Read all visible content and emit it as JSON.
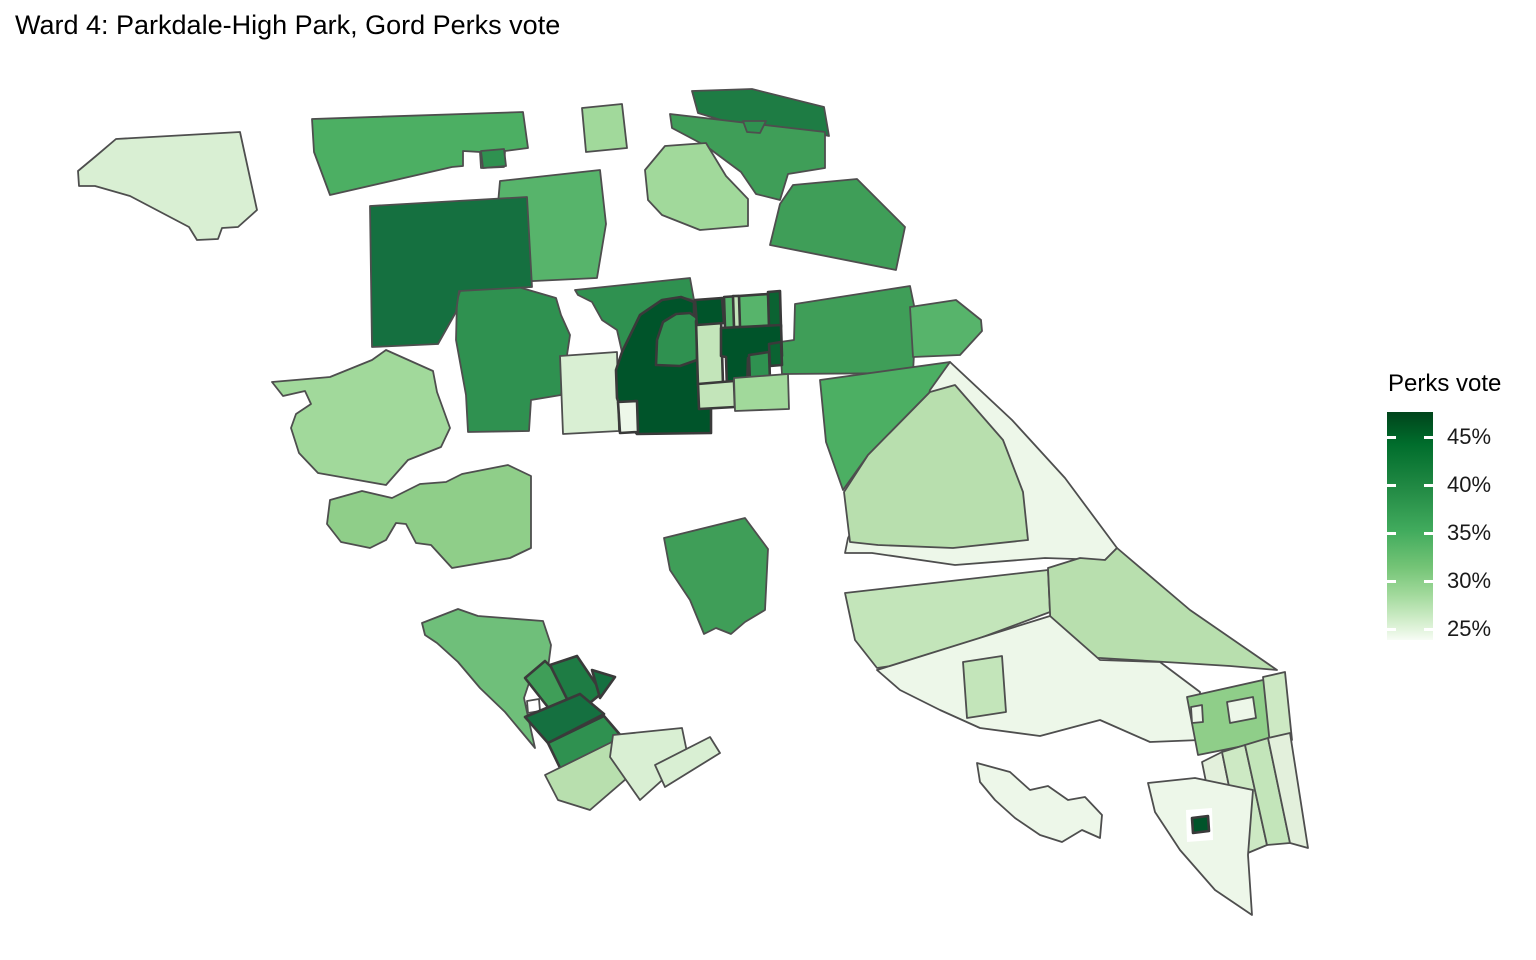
{
  "title": "Ward 4: Parkdale-High Park, Gord Perks vote",
  "legend": {
    "title": "Perks vote",
    "bar": {
      "width": 46,
      "height": 228
    },
    "gradient_stops": [
      {
        "color": "#00441b",
        "pos": 0
      },
      {
        "color": "#006d2c",
        "pos": 14
      },
      {
        "color": "#238b45",
        "pos": 34
      },
      {
        "color": "#41ab5d",
        "pos": 52
      },
      {
        "color": "#74c476",
        "pos": 68
      },
      {
        "color": "#a1d99b",
        "pos": 80
      },
      {
        "color": "#c7e9c0",
        "pos": 89
      },
      {
        "color": "#e5f5e0",
        "pos": 96
      },
      {
        "color": "#f7fcf5",
        "pos": 100
      }
    ],
    "ticks": [
      {
        "label": "45%",
        "y": 25
      },
      {
        "label": "40%",
        "y": 73
      },
      {
        "label": "35%",
        "y": 121
      },
      {
        "label": "30%",
        "y": 169
      },
      {
        "label": "25%",
        "y": 217
      }
    ]
  },
  "map_style": {
    "stroke": "#4e4e4e",
    "stroke_width": 1.8,
    "thick_stroke": "#3a3a3a",
    "thick_stroke_width": 2.6,
    "background": "#ffffff"
  },
  "chart_data": {
    "type": "heatmap",
    "subtype": "choropleth-map",
    "title": "Ward 4: Parkdale-High Park, Gord Perks vote",
    "legend_title": "Perks vote",
    "scale": {
      "tick_labels": [
        "45%",
        "40%",
        "35%",
        "30%",
        "25%"
      ],
      "min_pct": 25,
      "max_pct": 46,
      "palette": "Greens, light = low vote share, dark = high vote share"
    },
    "regions": [
      {
        "id": "nw-blob",
        "value": 27,
        "fill": "#d9efd3",
        "points": "78,171 96,156 116,139 240,132 257,210 238,227 222,228 218,239 197,240 189,227 130,196 95,186 79,186"
      },
      {
        "id": "top-strip-west",
        "value": 36,
        "fill": "#4caf63",
        "points": "312,119 523,112 528,148 505,151 504,167 481,168 480,152 463,151 463,166 452,167 330,195 314,152"
      },
      {
        "id": "top-strip-square",
        "value": 40,
        "fill": "#2f9150",
        "points": "481,151 504,149 506,166 483,168"
      },
      {
        "id": "north-centre",
        "value": 35,
        "fill": "#57b46b",
        "points": "500,181 600,170 606,224 597,278 513,282 497,215"
      },
      {
        "id": "light-quad-top",
        "value": 31,
        "fill": "#a1d99b",
        "points": "582,108 622,104 627,148 586,152"
      },
      {
        "id": "cross-centre",
        "value": 40,
        "fill": "#2f9150",
        "points": "465,277 503,271 508,284 556,298 561,315 570,335 561,395 531,400 529,431 468,432 466,395 456,340 457,300"
      },
      {
        "id": "dark-square-west",
        "value": 43,
        "fill": "#157040",
        "points": "370,206 527,197 532,287 459,291 456,312 438,344 372,347"
      },
      {
        "id": "pale-strip-mid",
        "value": 27,
        "fill": "#d9efd3",
        "points": "560,356 617,352 619,431 563,434"
      },
      {
        "id": "wavy-mid",
        "value": 40,
        "fill": "#2f9150",
        "points": "575,290 690,278 694,300 680,297 662,300 640,315 622,352 617,330 602,320 592,302 578,295"
      },
      {
        "id": "dark-top-strip",
        "value": 42,
        "fill": "#1e7c44",
        "points": "692,91 752,89 824,107 829,136 795,129 744,127 698,113"
      },
      {
        "id": "med-strip-ne",
        "value": 38,
        "fill": "#3f9e58",
        "points": "670,114 825,132 825,168 788,174 780,200 756,194 741,172 706,146 672,128"
      },
      {
        "id": "med-strip-tongue",
        "value": 40,
        "fill": "#2f9150",
        "points": "743,121 766,121 760,133 747,132"
      },
      {
        "id": "light-blob-ne",
        "value": 31,
        "fill": "#a1d99b",
        "points": "645,170 665,146 706,143 726,176 748,199 748,226 700,230 662,215 648,200"
      },
      {
        "id": "block-ne-1",
        "value": 38,
        "fill": "#3f9e58",
        "points": "793,185 857,179 905,227 896,270 770,245 780,204"
      },
      {
        "id": "block-ne-2",
        "value": 38,
        "fill": "#3f9e58",
        "points": "795,304 910,286 916,315 913,373 782,374 780,342 794,340"
      },
      {
        "id": "wing-ne",
        "value": 35,
        "fill": "#57b46b",
        "points": "910,307 956,300 981,320 982,331 960,355 913,357"
      },
      {
        "id": "east-parallelogram",
        "value": 36,
        "fill": "#4caf63",
        "points": "820,380 950,362 930,392 868,455 843,490 826,442"
      },
      {
        "id": "east-pale-wedge",
        "value": 25,
        "fill": "#edf7e9",
        "points": "930,390 950,362 1012,420 1065,478 1117,548 1105,560 1045,558 955,565 872,553 845,553 848,538 868,500 890,468 920,430"
      },
      {
        "id": "east-lightmed",
        "value": 30,
        "fill": "#b8dfae",
        "points": "868,455 930,392 955,385 1003,440 1023,492 1028,540 953,548 878,545 850,542 844,492"
      },
      {
        "id": "east-band-2",
        "value": 29,
        "fill": "#c3e5ba",
        "points": "845,593 1048,570 1050,612 913,663 877,668 855,640"
      },
      {
        "id": "coast-band",
        "value": 30,
        "fill": "#b8dfae",
        "points": "1048,568 1080,558 1105,560 1117,548 1190,610 1277,670 1230,666 1100,658 1052,657"
      },
      {
        "id": "se-pale-mid",
        "value": 25,
        "fill": "#edf7e9",
        "points": "877,670 1050,616 1100,660 1160,662 1200,692 1200,740 1150,742 1100,720 1040,736 980,728 940,710 900,690"
      },
      {
        "id": "se-small-rect",
        "value": 29,
        "fill": "#c3e5ba",
        "points": "963,662 1002,656 1006,712 967,718"
      },
      {
        "id": "se-hook-sliver",
        "value": 25,
        "fill": "#edf7e9",
        "points": "977,763 1010,772 1030,790 1048,786 1068,800 1085,797 1102,815 1100,838 1082,830 1062,842 1040,835 1015,818 995,800 980,782"
      },
      {
        "id": "se-block",
        "value": 32,
        "fill": "#8fce89",
        "points": "1187,697 1272,678 1283,738 1198,755"
      },
      {
        "id": "se-block-hole",
        "value": 25,
        "fill": "#edf7e9",
        "points": "1227,702 1253,697 1256,718 1230,723"
      },
      {
        "id": "se-block-notch",
        "value": 25,
        "fill": "#edf7e9",
        "points": "1191,707 1202,705 1203,722 1192,723"
      },
      {
        "id": "se-right-piece",
        "value": 28,
        "fill": "#cde9c4",
        "points": "1263,677 1285,672 1292,740 1270,745"
      },
      {
        "id": "se-strip-a",
        "value": 26,
        "fill": "#e3f0dc",
        "points": "1202,762 1222,752 1243,855 1221,857"
      },
      {
        "id": "se-strip-b",
        "value": 28,
        "fill": "#cde9c4",
        "points": "1222,752 1245,745 1267,845 1243,855"
      },
      {
        "id": "se-strip-c",
        "value": 29,
        "fill": "#c3e5ba",
        "points": "1245,745 1268,738 1290,843 1267,845"
      },
      {
        "id": "se-strip-d",
        "value": 26,
        "fill": "#e3f0dc",
        "points": "1268,738 1290,733 1308,848 1290,843"
      },
      {
        "id": "peninsula",
        "value": 25,
        "fill": "#edf7e9",
        "points": "1148,783 1195,778 1253,790 1248,855 1252,915 1215,890 1180,850 1155,812"
      },
      {
        "id": "peninsula-frame",
        "value": 25,
        "fill": "#ffffff",
        "points": "1186,810 1212,808 1213,840 1187,842",
        "nostroke": true
      },
      {
        "id": "peninsula-dark",
        "value": 46,
        "fill": "#00542a",
        "points": "1192,818 1208,816 1209,831 1193,833",
        "thick": true
      },
      {
        "id": "pentagon-mid",
        "value": 38,
        "fill": "#3f9e58",
        "points": "664,538 745,518 768,549 765,610 745,622 731,634 716,628 704,634 690,600 670,570"
      },
      {
        "id": "west-blob-1",
        "value": 31,
        "fill": "#a1d99b",
        "points": "272,382 330,377 372,360 386,350 433,371 437,392 450,428 441,447 408,460 386,485 352,479 318,473 299,453 291,428 296,414 311,404 305,391 283,396"
      },
      {
        "id": "west-blob-2",
        "value": 32,
        "fill": "#8fce89",
        "points": "330,500 362,491 392,498 420,484 446,482 462,474 508,465 531,476 531,548 510,558 452,568 431,545 416,543 406,524 396,523 386,540 370,548 341,542 327,524"
      },
      {
        "id": "cluster-dark-main",
        "value": 46,
        "fill": "#00542a",
        "points": "622,352 640,315 662,300 681,297 694,302 694,324 701,326 701,368 711,371 711,433 637,434 625,420 617,398 616,370",
        "thick": true
      },
      {
        "id": "cluster-arc",
        "value": 40,
        "fill": "#2f9150",
        "points": "656,365 657,340 663,322 676,314 690,313 697,318 697,360 680,366",
        "thick": true
      },
      {
        "id": "cluster-pale-bl",
        "value": 25,
        "fill": "#edf7e9",
        "points": "618,402 637,401 638,432 620,433",
        "thick": true
      },
      {
        "id": "cluster-light-col",
        "value": 29,
        "fill": "#c3e5ba",
        "points": "696,321 721,319 723,384 698,386",
        "thick": true
      },
      {
        "id": "cluster-dark-sq",
        "value": 46,
        "fill": "#00542a",
        "points": "695,300 722,298 724,323 697,325",
        "thick": true
      },
      {
        "id": "cluster-med-col",
        "value": 35,
        "fill": "#57b46b",
        "points": "724,297 768,294 770,326 725,328",
        "thick": true
      },
      {
        "id": "cluster-sliver",
        "value": 29,
        "fill": "#c3e5ba",
        "points": "733,296 739,296 740,327 734,327",
        "thick": true
      },
      {
        "id": "cluster-dark-r",
        "value": 45,
        "fill": "#0b6332",
        "points": "768,292 780,291 781,327 769,328",
        "thick": true
      },
      {
        "id": "cluster-dark-L",
        "value": 46,
        "fill": "#00542a",
        "points": "721,328 781,325 782,356 748,358 747,390 727,389 726,357 721,356",
        "thick": true
      },
      {
        "id": "cluster-med-sq",
        "value": 40,
        "fill": "#2f9150",
        "points": "749,355 769,352 770,380 750,382",
        "thick": true
      },
      {
        "id": "cluster-dark-sm",
        "value": 45,
        "fill": "#0b6332",
        "points": "769,344 781,342 782,365 770,366",
        "thick": true
      },
      {
        "id": "cluster-light-bm",
        "value": 29,
        "fill": "#c3e5ba",
        "points": "698,384 734,381 735,407 699,409",
        "thick": true
      },
      {
        "id": "cluster-lm-br",
        "value": 31,
        "fill": "#a1d99b",
        "points": "734,378 788,374 789,409 735,411"
      },
      {
        "id": "sw-blob",
        "value": 34,
        "fill": "#6fbf7a",
        "points": "422,623 458,609 478,616 543,621 551,645 548,668 530,680 524,698 527,712 535,748 520,730 505,712 480,688 458,662 437,643 425,635"
      },
      {
        "id": "sw-blob-hole",
        "value": 34,
        "fill": "#ffffff",
        "points": "527,701 539,699 540,711 528,713"
      },
      {
        "id": "sw-med-rect",
        "value": 38,
        "fill": "#3f9e58",
        "points": "525,678 545,661 580,695 558,720",
        "thick": true
      },
      {
        "id": "sw-dark-rect",
        "value": 42,
        "fill": "#1e7c44",
        "points": "550,665 577,656 602,693 575,715",
        "thick": true
      },
      {
        "id": "sw-dark-wing",
        "value": 43,
        "fill": "#157040",
        "points": "592,670 615,677 600,698",
        "thick": true
      },
      {
        "id": "sw-dark-band",
        "value": 43,
        "fill": "#157040",
        "points": "525,717 580,694 604,714 548,743",
        "thick": true
      },
      {
        "id": "sw-med-band",
        "value": 40,
        "fill": "#2f9150",
        "points": "548,743 604,716 622,737 562,772",
        "thick": true
      },
      {
        "id": "sw-light-rect",
        "value": 30,
        "fill": "#b8dfae",
        "points": "545,775 620,738 648,760 590,810 558,800"
      },
      {
        "id": "sw-pale-rect",
        "value": 27,
        "fill": "#d9efd3",
        "points": "613,735 682,728 688,757 640,800 610,757"
      },
      {
        "id": "sw-pale-rect-2",
        "value": 27,
        "fill": "#d9efd3",
        "points": "655,765 710,737 720,753 665,787"
      }
    ]
  }
}
